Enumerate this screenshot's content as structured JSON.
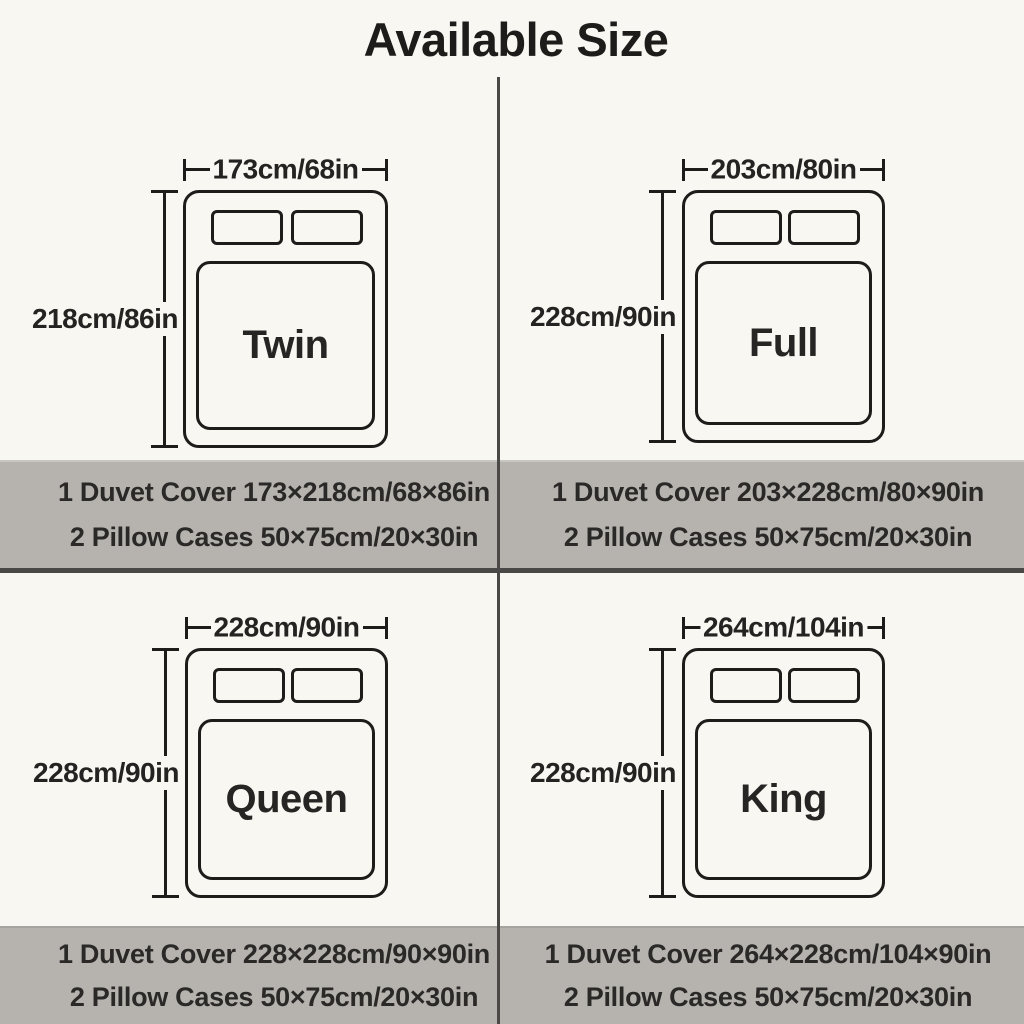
{
  "title": "Available Size",
  "colors": {
    "background": "#f8f7f2",
    "banner": "#b6b3ae",
    "banner_edge_top": "#c9c6c1",
    "banner_edge_bottom": "#a7a49f",
    "divider": "#4a4947",
    "line": "#1d1c1a",
    "text": "#242321"
  },
  "sizes": [
    {
      "name": "Twin",
      "width_label": "173cm/68in",
      "height_label": "218cm/86in",
      "duvet_spec": "1 Duvet Cover 173×218cm/68×86in",
      "pillow_spec": "2 Pillow Cases 50×75cm/20×30in"
    },
    {
      "name": "Full",
      "width_label": "203cm/80in",
      "height_label": "228cm/90in",
      "duvet_spec": "1 Duvet Cover 203×228cm/80×90in",
      "pillow_spec": "2 Pillow Cases 50×75cm/20×30in"
    },
    {
      "name": "Queen",
      "width_label": "228cm/90in",
      "height_label": "228cm/90in",
      "duvet_spec": "1 Duvet Cover 228×228cm/90×90in",
      "pillow_spec": "2 Pillow Cases 50×75cm/20×30in"
    },
    {
      "name": "King",
      "width_label": "264cm/104in",
      "height_label": "228cm/90in",
      "duvet_spec": "1 Duvet Cover 264×228cm/104×90in",
      "pillow_spec": "2 Pillow Cases 50×75cm/20×30in"
    }
  ]
}
